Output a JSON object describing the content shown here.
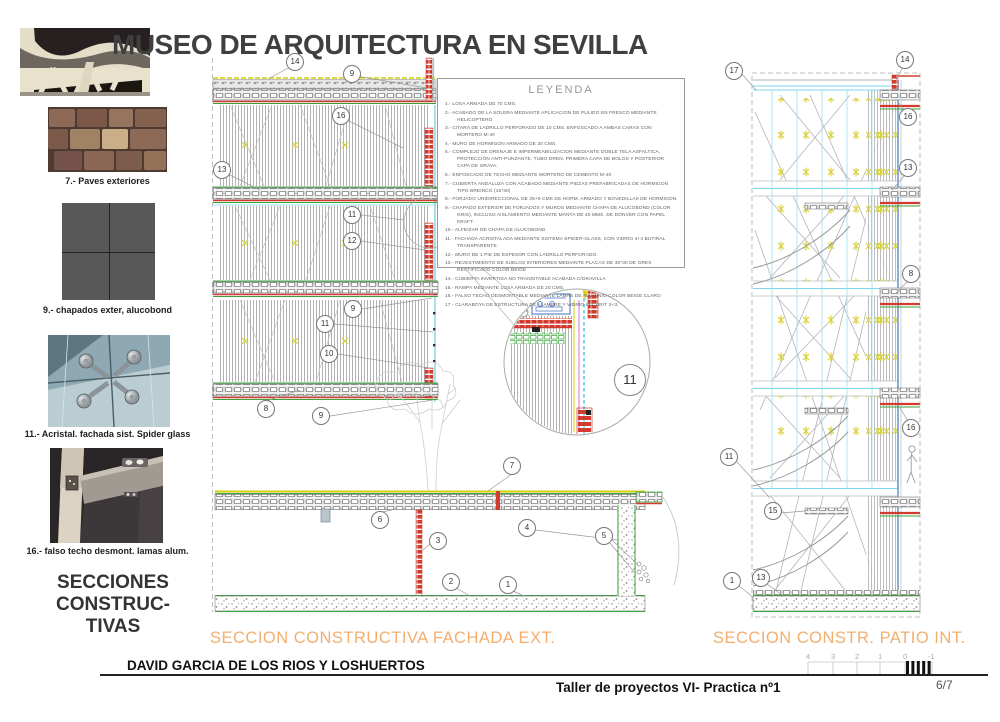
{
  "title": "MUSEO DE ARQUITECTURA EN SEVILLA",
  "sidebar": {
    "items": [
      {
        "label": "7.- Paves exteriores"
      },
      {
        "label": "9.- chapados exter, alucobond"
      },
      {
        "label": "11.- Acristal. fachada sist. Spider glass"
      },
      {
        "label": "16.- falso techo desmont. lamas alum."
      }
    ],
    "section_title_lines": [
      "SECCIONES",
      "CONSTRUC-",
      "TIVAS"
    ]
  },
  "legend": {
    "title": "LEYENDA",
    "items": [
      "1.- LOSA ARMADA DE 70 CMS.",
      "2.- ACABADO DE LA SOLERA MEDIANTE APLICACION DE PULIDO EN FRESCO MEDIANTE HELICOPTERO",
      "3.- CITARA DE LADRILLO PERFORADO DE 10 CMS. ENFOSCADO A AMBAS CARAS CON MORTERO M-40",
      "4.- MURO DE HORMIGON ARMADO DE 30 CMS.",
      "5.- COMPLEJO DE DRENAJE E IMPERMEABILIZACION MEDIANTE DOBLE TELA ASFALTICA, PROTECCIÓN ANTI-PUNZANTE, TUBO DREN, PRIMERA CAPA DE BOLOS Y POSTERIOR CAPA DE GRAVA.",
      "6.- ENFOSCADO DE TECHO MEDIANTE MORTERO DE CEMENTO M-40",
      "7.- CUBIERTA ANDALUZA CON ACABADO MEDIANTE PIEZAS PREFABRICADAS DE HORMIGON TIPO BREINCO (15*30)",
      "8.- FORJADO UNIDIRECCIONAL DE 25+5 CMS DE HORM. ARMADO Y BOVEDILLAS DE HORMIGON.",
      "9.- CHAPADO EXTERIOR DE FORJADOS Y MUROS MEDIANTE CHAPA DE ALUCOBOND (COLOR GRIS), INCLUSO AISLAMIENTO MEDIANTE MANTA DE 40 MMS. DE DONVER CON PAPEL KRAFT.",
      "10.- ALFEIZAR DE CHAPA DE ALUCOBOND",
      "11.- FACHADA ACRISTALADA MEDIANTE SISTEMA SPIDER-GLASS, CON VIDRIO 4+4 BUTIRAL TRANSPARENTE.",
      "12.- MURO DE 1 PIE DE ESPESOR CON LADRILLO PERFORADO.",
      "13.- REVESTIMIENTO DE SUELOS INTERIORES MEDIANTE PLACAS DE 30*30 DE GRES RECTIFICADO COLOR BEIGE",
      "14.- CUBIERTA INVERTIDA NO TRANSITABLE ACABADA C/GRAVILLA",
      "15.- RAMPA MEDIANTE LOSA ARMADA DE 20 CMS.",
      "16.- FALSO TECHO DESMONTABLE MEDIANTE LAMAS DE ALUMINIO COLOR BEIGE CLARO",
      "17.- CLARABOYA DE ESTRUCTURA DE ALAMBRE Y VIDRIO SECURIT 3+3."
    ]
  },
  "drawings": {
    "facade": {
      "title": "SECCION CONSTRUCTIVA FACHADA EXT.",
      "callouts": [
        {
          "n": "14",
          "x": 295,
          "y": 62
        },
        {
          "n": "9",
          "x": 352,
          "y": 74
        },
        {
          "n": "16",
          "x": 341,
          "y": 116
        },
        {
          "n": "13",
          "x": 222,
          "y": 170
        },
        {
          "n": "11",
          "x": 352,
          "y": 215
        },
        {
          "n": "12",
          "x": 352,
          "y": 241
        },
        {
          "n": "9",
          "x": 353,
          "y": 309
        },
        {
          "n": "11",
          "x": 325,
          "y": 324
        },
        {
          "n": "10",
          "x": 329,
          "y": 354
        },
        {
          "n": "8",
          "x": 266,
          "y": 409
        },
        {
          "n": "9",
          "x": 321,
          "y": 416
        },
        {
          "n": "7",
          "x": 512,
          "y": 466
        },
        {
          "n": "6",
          "x": 380,
          "y": 520
        },
        {
          "n": "3",
          "x": 438,
          "y": 541
        },
        {
          "n": "4",
          "x": 527,
          "y": 528
        },
        {
          "n": "5",
          "x": 604,
          "y": 536
        },
        {
          "n": "2",
          "x": 451,
          "y": 582
        },
        {
          "n": "1",
          "x": 508,
          "y": 585
        },
        {
          "n": "11",
          "x": 630,
          "y": 380,
          "lg": true
        }
      ]
    },
    "patio": {
      "title": "SECCION CONSTR. PATIO INT.",
      "callouts": [
        {
          "n": "17",
          "x": 734,
          "y": 71
        },
        {
          "n": "14",
          "x": 905,
          "y": 60
        },
        {
          "n": "16",
          "x": 908,
          "y": 117
        },
        {
          "n": "13",
          "x": 908,
          "y": 168
        },
        {
          "n": "8",
          "x": 911,
          "y": 274
        },
        {
          "n": "16",
          "x": 911,
          "y": 428
        },
        {
          "n": "11",
          "x": 729,
          "y": 457
        },
        {
          "n": "15",
          "x": 773,
          "y": 511
        },
        {
          "n": "13",
          "x": 761,
          "y": 578
        },
        {
          "n": "1",
          "x": 732,
          "y": 581
        }
      ]
    }
  },
  "footer": {
    "author": "DAVID GARCIA DE LOS RIOS Y LOSHUERTOS",
    "course": "Taller de proyectos VI- Practica nº1",
    "page": "6/7",
    "scale_ticks": [
      "4",
      "3",
      "2",
      "1",
      "0",
      "-1"
    ]
  },
  "colors": {
    "accent_orange": "#f3ae6e",
    "drawing_red": "#d23b2e",
    "drawing_green": "#3aa33a",
    "drawing_cyan": "#7fd4ee",
    "drawing_yellow": "#d6cf00"
  }
}
